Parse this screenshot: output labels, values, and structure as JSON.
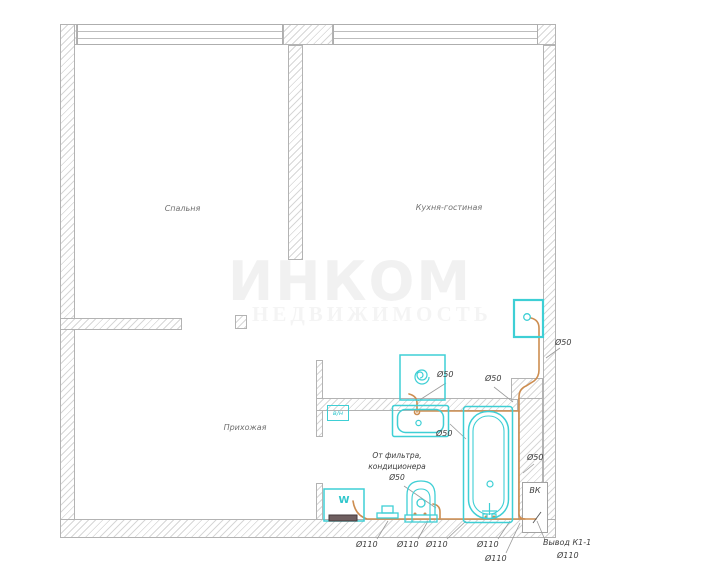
{
  "drawing": {
    "type": "apartment floor plan – drainage/sewage scheme",
    "rooms": {
      "bedroom": "Спальня",
      "kitchen": "Кухня-гостиная",
      "hallway": "Прихожая"
    },
    "labels": {
      "d50": "Ø50",
      "d110": "Ø110",
      "vk": "ВК",
      "vn": "в/н",
      "w": "W",
      "outlet": "Вывод К1-1"
    },
    "filter_note": {
      "line1": "От фильтра,",
      "line2": "кондиционера",
      "line3": "Ø50"
    },
    "watermark": {
      "line1": "ИНКОМ",
      "line2": "НЕДВИЖИМОСТЬ"
    },
    "colors": {
      "fixture_cyan": "#3ecfd5",
      "pipe_orange": "#cd8d50",
      "wall_line": "#b3b3b3",
      "hatch": "#d7d7d7",
      "label_text": "#3d3d3d"
    }
  }
}
